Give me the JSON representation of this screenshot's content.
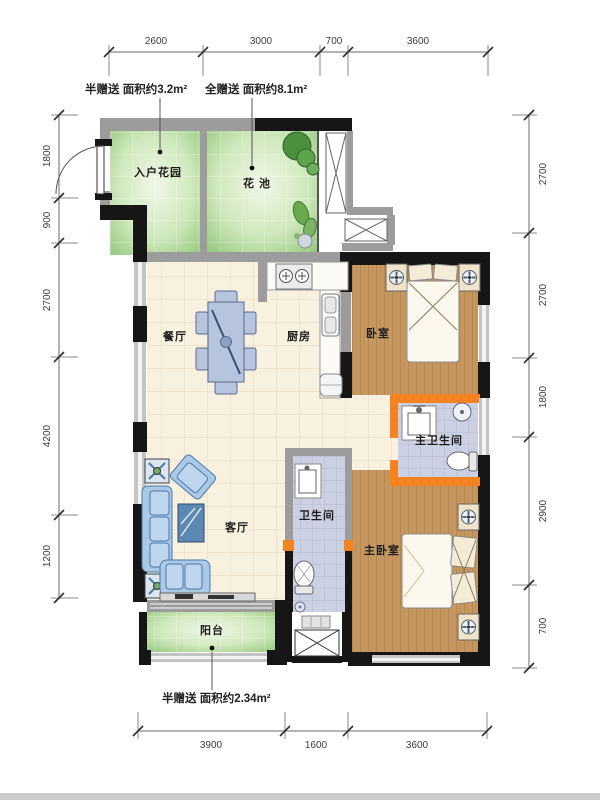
{
  "annotations": {
    "gift_top_left": "半赠送 面积约3.2m²",
    "gift_top_right": "全赠送 面积约8.1m²",
    "gift_bottom": "半赠送 面积约2.34m²"
  },
  "rooms": {
    "entry_garden": "入户花园",
    "flower_bed": "花 池",
    "dining_room": "餐厅",
    "kitchen": "厨房",
    "bedroom": "卧室",
    "master_bathroom": "主卫生间",
    "bathroom": "卫生间",
    "living_room": "客厅",
    "master_bedroom": "主卧室",
    "balcony": "阳台"
  },
  "dimensions": {
    "top": [
      "2600",
      "3000",
      "700",
      "3600"
    ],
    "bottom": [
      "3900",
      "1600",
      "3600"
    ],
    "left": [
      "1800",
      "900",
      "2700",
      "4200",
      "1200"
    ],
    "right": [
      "2700",
      "2700",
      "1800",
      "2900",
      "700"
    ]
  },
  "colors": {
    "wall_structural": "#161616",
    "wall_light": "#9c9c9c",
    "wall_new_orange": "#f5831f",
    "floor_tile": "#f9f1e0",
    "floor_wood": "#c79760",
    "floor_bath_tile": "#cbd0e2",
    "garden_green": "#96c97e",
    "furniture_blue": "#aac9e6"
  }
}
